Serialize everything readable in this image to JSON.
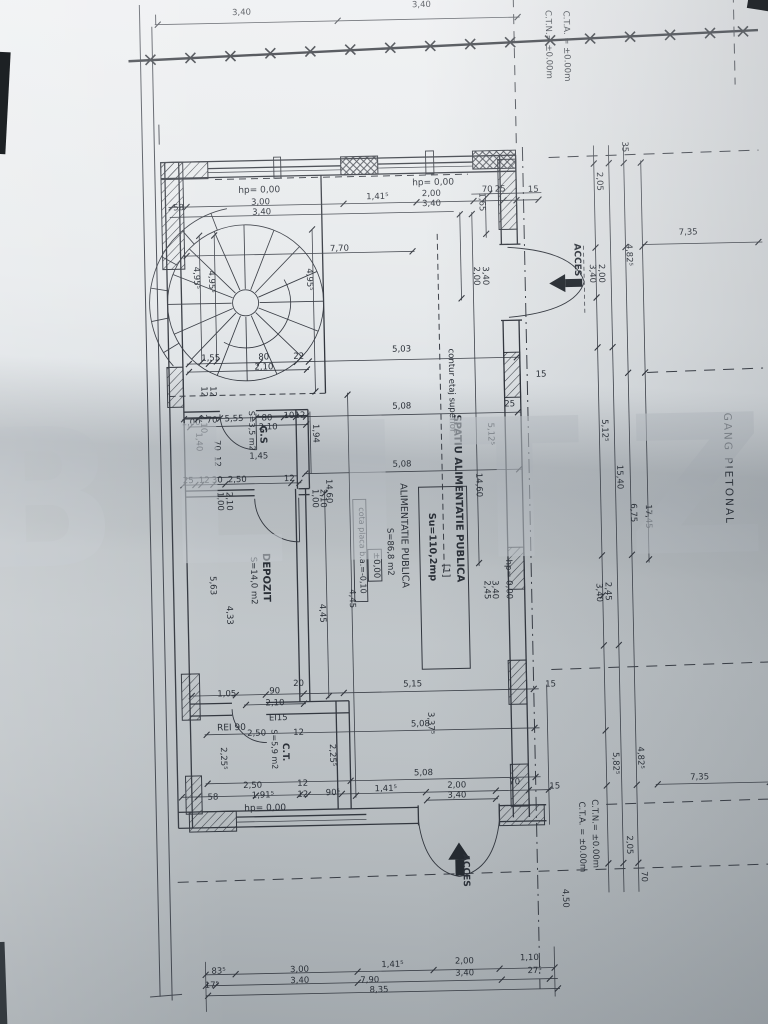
{
  "watermark": "BLITZ",
  "labels": [
    {
      "t": "3,40",
      "x": 252,
      "y": 12,
      "n": "site-dim"
    },
    {
      "t": "3,40",
      "x": 432,
      "y": 8,
      "n": "site-dim"
    },
    {
      "t": "C.T.N.= ±0.00m",
      "x": 556,
      "y": 48,
      "r": 1,
      "n": "level-note-ctn-top"
    },
    {
      "t": "C.T.A. = ±0.00m",
      "x": 574,
      "y": 50,
      "r": 1,
      "n": "level-note-cta-top"
    },
    {
      "t": "35",
      "x": 630,
      "y": 152,
      "r": 1,
      "n": "dim"
    },
    {
      "t": "2,05",
      "x": 604,
      "y": 186,
      "r": 1,
      "n": "dim"
    },
    {
      "t": "4,82⁵",
      "x": 632,
      "y": 260,
      "r": 1,
      "n": "dim"
    },
    {
      "t": "7,35",
      "x": 694,
      "y": 241,
      "n": "dim"
    },
    {
      "t": "2,00",
      "x": 604,
      "y": 278,
      "r": 1,
      "n": "dim"
    },
    {
      "t": "3,40",
      "x": 595,
      "y": 278,
      "r": 1,
      "n": "dim"
    },
    {
      "t": "5,12⁵",
      "x": 604,
      "y": 435,
      "r": 1,
      "n": "dim"
    },
    {
      "t": "15,40",
      "x": 618,
      "y": 482,
      "r": 1,
      "n": "dim"
    },
    {
      "t": "6,75",
      "x": 631,
      "y": 518,
      "r": 1,
      "n": "dim"
    },
    {
      "t": "17,45",
      "x": 646,
      "y": 522,
      "r": 1,
      "n": "dim"
    },
    {
      "t": "GANG PIETONAL",
      "x": 726,
      "y": 476,
      "r": 1,
      "s": 10.5,
      "sp": 2,
      "n": "gang-pietonal-label"
    },
    {
      "t": "2,45",
      "x": 604,
      "y": 596,
      "r": 1,
      "n": "dim"
    },
    {
      "t": "3,40",
      "x": 595,
      "y": 597,
      "r": 1,
      "n": "dim"
    },
    {
      "t": "5,82⁵",
      "x": 608,
      "y": 768,
      "r": 1,
      "n": "dim"
    },
    {
      "t": "4,82⁵",
      "x": 633,
      "y": 763,
      "r": 1,
      "n": "dim"
    },
    {
      "t": "7,35",
      "x": 694,
      "y": 786,
      "n": "dim"
    },
    {
      "t": "C.T.N.= ±0.00m",
      "x": 586,
      "y": 838,
      "r": 1,
      "n": "level-note-ctn-bottom"
    },
    {
      "t": "C.T.A. = ±0.00m",
      "x": 573,
      "y": 841,
      "r": 1,
      "n": "level-note-cta-bottom"
    },
    {
      "t": "2,05",
      "x": 620,
      "y": 850,
      "r": 1,
      "n": "dim"
    },
    {
      "t": "70",
      "x": 634,
      "y": 882,
      "r": 1,
      "n": "dim"
    },
    {
      "t": "4,50",
      "x": 555,
      "y": 902,
      "r": 1,
      "n": "dim"
    },
    {
      "t": "15",
      "x": 540,
      "y": 195,
      "n": "dim"
    },
    {
      "t": "15",
      "x": 544,
      "y": 380,
      "n": "dim"
    },
    {
      "t": "15",
      "x": 547,
      "y": 690,
      "n": "dim"
    },
    {
      "t": "15",
      "x": 549,
      "y": 792,
      "n": "dim"
    },
    {
      "t": "58",
      "x": 185,
      "y": 206,
      "n": "dim"
    },
    {
      "t": "hp= 0,00",
      "x": 266,
      "y": 190,
      "s": 9,
      "n": "hp-label"
    },
    {
      "t": "3,00",
      "x": 267,
      "y": 202,
      "n": "dim"
    },
    {
      "t": "3,40",
      "x": 268,
      "y": 212,
      "n": "dim"
    },
    {
      "t": "1,41⁵",
      "x": 384,
      "y": 199,
      "n": "dim"
    },
    {
      "t": "hp= 0,00",
      "x": 440,
      "y": 186,
      "s": 9,
      "n": "hp-label"
    },
    {
      "t": "2,00",
      "x": 438,
      "y": 197,
      "n": "dim"
    },
    {
      "t": "3,40",
      "x": 438,
      "y": 207,
      "n": "dim"
    },
    {
      "t": "70",
      "x": 494,
      "y": 194,
      "n": "dim"
    },
    {
      "t": "25",
      "x": 507,
      "y": 194,
      "n": "dim"
    },
    {
      "t": "1,65",
      "x": 486,
      "y": 204,
      "r": 1,
      "n": "dim"
    },
    {
      "t": "7,70",
      "x": 345,
      "y": 250,
      "n": "dim"
    },
    {
      "t": "4,95⁵",
      "x": 199,
      "y": 274,
      "r": 1,
      "n": "dim"
    },
    {
      "t": "4,95⁵",
      "x": 214,
      "y": 278,
      "r": 1,
      "n": "dim"
    },
    {
      "t": "4,95⁵",
      "x": 312,
      "y": 278,
      "r": 1,
      "n": "dim"
    },
    {
      "t": "2,00",
      "x": 479,
      "y": 278,
      "r": 1,
      "n": "dim"
    },
    {
      "t": "3,40",
      "x": 488,
      "y": 278,
      "r": 1,
      "n": "dim"
    },
    {
      "t": "ACCES",
      "x": 580,
      "y": 264,
      "r": 1,
      "s": 9,
      "w": "bold",
      "n": "acces-label-right"
    },
    {
      "t": "1,55",
      "x": 214,
      "y": 357,
      "n": "dim"
    },
    {
      "t": "80",
      "x": 267,
      "y": 357,
      "n": "dim"
    },
    {
      "t": "22",
      "x": 302,
      "y": 357,
      "n": "dim"
    },
    {
      "t": "2,10",
      "x": 267,
      "y": 367,
      "n": "dim"
    },
    {
      "t": "12",
      "x": 204,
      "y": 388,
      "r": 1,
      "n": "dim"
    },
    {
      "t": "12",
      "x": 213,
      "y": 388,
      "r": 1,
      "n": "dim"
    },
    {
      "t": "1,00",
      "x": 193,
      "y": 421,
      "n": "dim"
    },
    {
      "t": "70",
      "x": 214,
      "y": 419,
      "n": "dim"
    },
    {
      "t": "5,55",
      "x": 236,
      "y": 418,
      "n": "dim"
    },
    {
      "t": "80",
      "x": 269,
      "y": 418,
      "n": "dim"
    },
    {
      "t": "10",
      "x": 291,
      "y": 416,
      "n": "dim"
    },
    {
      "t": "12",
      "x": 302,
      "y": 416,
      "n": "dim"
    },
    {
      "t": "2,10",
      "x": 203,
      "y": 420,
      "r": 1,
      "n": "dim"
    },
    {
      "t": "2,10",
      "x": 270,
      "y": 427,
      "n": "dim"
    },
    {
      "t": "G.S",
      "x": 262,
      "y": 432,
      "r": 1,
      "s": 9.5,
      "w": "bold",
      "n": "room-label-gs"
    },
    {
      "t": "S=3,5 m2",
      "x": 251,
      "y": 428,
      "r": 1,
      "s": 8,
      "n": "room-area-gs"
    },
    {
      "t": "1,45",
      "x": 260,
      "y": 456,
      "n": "dim"
    },
    {
      "t": "1,40",
      "x": 198,
      "y": 438,
      "r": 1,
      "n": "dim"
    },
    {
      "t": "70",
      "x": 216,
      "y": 442,
      "r": 1,
      "n": "dim"
    },
    {
      "t": "12",
      "x": 216,
      "y": 458,
      "r": 1,
      "n": "dim"
    },
    {
      "t": "25",
      "x": 189,
      "y": 479,
      "n": "dim"
    },
    {
      "t": "12",
      "x": 205,
      "y": 479,
      "n": "dim"
    },
    {
      "t": "30",
      "x": 218,
      "y": 479,
      "n": "dim"
    },
    {
      "t": "2,50",
      "x": 238,
      "y": 479,
      "n": "dim"
    },
    {
      "t": "12",
      "x": 290,
      "y": 479,
      "n": "dim"
    },
    {
      "t": "1,00",
      "x": 218,
      "y": 498,
      "r": 1,
      "n": "dim"
    },
    {
      "t": "2,10",
      "x": 227,
      "y": 498,
      "r": 1,
      "n": "dim"
    },
    {
      "t": "14,60",
      "x": 327,
      "y": 490,
      "r": 1,
      "n": "dim"
    },
    {
      "t": "1,00",
      "x": 313,
      "y": 497,
      "r": 1,
      "n": "dim"
    },
    {
      "t": "2,10",
      "x": 321,
      "y": 497,
      "r": 1,
      "n": "dim"
    },
    {
      "t": "DEPOZIT",
      "x": 262,
      "y": 575,
      "r": 1,
      "s": 10,
      "w": "bold",
      "n": "room-label-depozit"
    },
    {
      "t": "S=14,0 m2",
      "x": 250,
      "y": 578,
      "r": 1,
      "n": "room-area-depozit"
    },
    {
      "t": "5,63",
      "x": 209,
      "y": 582,
      "r": 1,
      "n": "dim"
    },
    {
      "t": "4,33",
      "x": 225,
      "y": 612,
      "r": 1,
      "n": "dim"
    },
    {
      "t": "4,45",
      "x": 318,
      "y": 612,
      "r": 1,
      "n": "dim"
    },
    {
      "t": "4,45",
      "x": 348,
      "y": 598,
      "r": 1,
      "n": "dim"
    },
    {
      "t": "1,94",
      "x": 315,
      "y": 432,
      "r": 1,
      "n": "dim"
    },
    {
      "t": "14,60",
      "x": 477,
      "y": 487,
      "r": 1,
      "n": "dim"
    },
    {
      "t": "5,12⁵",
      "x": 490,
      "y": 436,
      "r": 1,
      "n": "dim"
    },
    {
      "t": "5,03",
      "x": 405,
      "y": 352,
      "n": "dim"
    },
    {
      "t": "5,08",
      "x": 404,
      "y": 409,
      "n": "dim"
    },
    {
      "t": "25",
      "x": 512,
      "y": 409,
      "n": "dim"
    },
    {
      "t": "5,08",
      "x": 403,
      "y": 467,
      "n": "dim"
    },
    {
      "t": "contur etaj superior",
      "x": 452,
      "y": 392,
      "r": 1,
      "s": 8.5,
      "n": "contur-etaj-label"
    },
    {
      "t": "SPATIU ALIMENTATIE PUBLICA",
      "x": 456,
      "y": 500,
      "r": 1,
      "s": 10,
      "w": "bold",
      "n": "space-name-label"
    },
    {
      "t": "[1]",
      "x": 442,
      "y": 572,
      "r": 1,
      "s": 9.5,
      "n": "unit-number-label"
    },
    {
      "t": "Su=110,2mp",
      "x": 429,
      "y": 548,
      "r": 1,
      "s": 9.5,
      "w": "bold",
      "n": "space-area-label"
    },
    {
      "t": "ALIMENTATIE PUBLICA",
      "x": 401,
      "y": 536,
      "r": 1,
      "s": 9.5,
      "n": "function-label"
    },
    {
      "t": "S=86,8 m2",
      "x": 387,
      "y": 552,
      "r": 1,
      "s": 8.5,
      "n": "function-area-label"
    },
    {
      "t": "±0,00",
      "x": 373,
      "y": 565,
      "r": 1,
      "s": 8.5,
      "box": 1,
      "n": "level-mark-label"
    },
    {
      "t": "cota placa b.a.=-0,10",
      "x": 359,
      "y": 550,
      "r": 1,
      "s": 8,
      "box": 1,
      "n": "slab-note-label"
    },
    {
      "t": "hp= 0,00",
      "x": 505,
      "y": 582,
      "r": 1,
      "s": 8.5,
      "n": "hp-label"
    },
    {
      "t": "2,45",
      "x": 483,
      "y": 592,
      "r": 1,
      "n": "dim"
    },
    {
      "t": "3,40",
      "x": 491,
      "y": 592,
      "r": 1,
      "n": "dim"
    },
    {
      "t": "5,15",
      "x": 409,
      "y": 687,
      "n": "dim"
    },
    {
      "t": "5,08",
      "x": 416,
      "y": 727,
      "n": "dim"
    },
    {
      "t": "5,08",
      "x": 418,
      "y": 776,
      "n": "dim"
    },
    {
      "t": "3,37⁵",
      "x": 424,
      "y": 724,
      "r": 1,
      "n": "dim"
    },
    {
      "t": "2,25⁵",
      "x": 216,
      "y": 755,
      "r": 1,
      "n": "dim"
    },
    {
      "t": "2,25⁵",
      "x": 325,
      "y": 754,
      "r": 1,
      "n": "dim"
    },
    {
      "t": "1,05",
      "x": 223,
      "y": 693,
      "n": "dim"
    },
    {
      "t": "90",
      "x": 271,
      "y": 691,
      "n": "dim"
    },
    {
      "t": "2,10",
      "x": 271,
      "y": 703,
      "n": "dim"
    },
    {
      "t": "20",
      "x": 295,
      "y": 684,
      "n": "dim"
    },
    {
      "t": "EI15",
      "x": 274,
      "y": 718,
      "s": 8.5,
      "n": "fire-rating-ei15"
    },
    {
      "t": "REI 90",
      "x": 227,
      "y": 727,
      "s": 9,
      "n": "fire-rating-rei90"
    },
    {
      "t": "2,50",
      "x": 252,
      "y": 733,
      "n": "dim"
    },
    {
      "t": "12",
      "x": 294,
      "y": 733,
      "n": "dim"
    },
    {
      "t": "C.T.",
      "x": 278,
      "y": 750,
      "r": 1,
      "s": 9,
      "w": "bold",
      "n": "room-label-ct"
    },
    {
      "t": "S=5,9 m2",
      "x": 267,
      "y": 747,
      "r": 1,
      "s": 8,
      "n": "room-area-ct"
    },
    {
      "t": "2,50",
      "x": 247,
      "y": 785,
      "n": "dim"
    },
    {
      "t": "12",
      "x": 297,
      "y": 784,
      "n": "dim"
    },
    {
      "t": "58",
      "x": 207,
      "y": 796,
      "n": "dim"
    },
    {
      "t": "1,91⁵",
      "x": 257,
      "y": 795,
      "n": "dim"
    },
    {
      "t": "12",
      "x": 297,
      "y": 795,
      "n": "dim"
    },
    {
      "t": "90⁵",
      "x": 327,
      "y": 794,
      "n": "dim"
    },
    {
      "t": "hp= 0,00",
      "x": 259,
      "y": 808,
      "s": 9,
      "n": "hp-label"
    },
    {
      "t": "1,41⁵",
      "x": 380,
      "y": 791,
      "n": "dim"
    },
    {
      "t": "2,00",
      "x": 451,
      "y": 789,
      "n": "dim"
    },
    {
      "t": "3,40",
      "x": 451,
      "y": 799,
      "n": "dim"
    },
    {
      "t": "70",
      "x": 509,
      "y": 787,
      "n": "dim"
    },
    {
      "t": "ACCES",
      "x": 456,
      "y": 872,
      "r": 1,
      "s": 9,
      "w": "bold",
      "n": "acces-label-bottom"
    },
    {
      "t": "83⁵",
      "x": 209,
      "y": 970,
      "n": "dim"
    },
    {
      "t": "3,00",
      "x": 290,
      "y": 970,
      "n": "dim"
    },
    {
      "t": "1,41⁵",
      "x": 383,
      "y": 967,
      "n": "dim"
    },
    {
      "t": "2,00",
      "x": 455,
      "y": 965,
      "n": "dim"
    },
    {
      "t": "1,10",
      "x": 520,
      "y": 963,
      "n": "dim"
    },
    {
      "t": "17⁵",
      "x": 202,
      "y": 984,
      "n": "dim"
    },
    {
      "t": "3,40",
      "x": 290,
      "y": 981,
      "n": "dim"
    },
    {
      "t": "7,90",
      "x": 360,
      "y": 982,
      "n": "dim"
    },
    {
      "t": "3,40",
      "x": 455,
      "y": 977,
      "n": "dim"
    },
    {
      "t": "27⁵",
      "x": 525,
      "y": 976,
      "n": "dim"
    },
    {
      "t": "8,35",
      "x": 369,
      "y": 992,
      "n": "dim"
    }
  ]
}
